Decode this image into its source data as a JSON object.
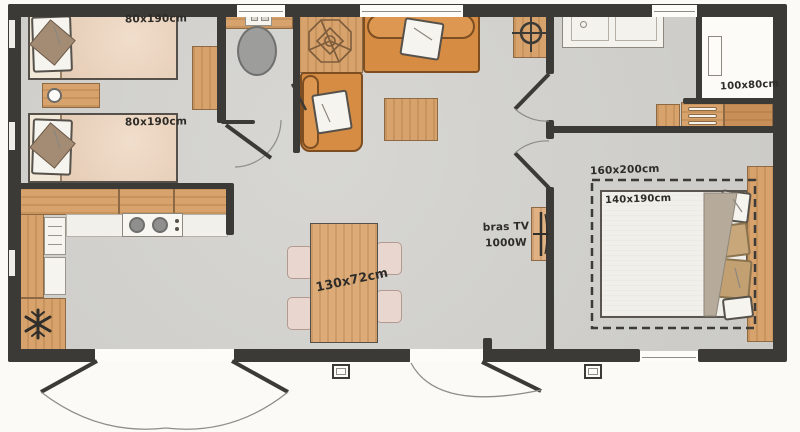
{
  "plan": {
    "type": "mobile-home floor plan",
    "labels": {
      "bed_single_top": "80x190cm",
      "bed_single_bottom": "80x190cm",
      "shower": "100x80cm",
      "master_zone": "160x200cm",
      "master_bed": "140x190cm",
      "tv_line1": "bras TV",
      "tv_line2": "1000W",
      "dining_table": "130x72cm"
    },
    "colors": {
      "wall": "#3b3a37",
      "floor": "#d3d2ce",
      "wood": "#d7a26c",
      "sofa_orange": "#d78c43",
      "duvet_peach": "#ecd2ba",
      "cushion_taupe": "#a38b74",
      "pillow_tan": "#c8a77b",
      "chair_pink": "#e9d7cf",
      "toilet_gray": "#9c9c9a",
      "exterior": "#fbfaf7"
    },
    "icons": {
      "fridge": "snowflake-icon",
      "water_heater": "crosshair-icon",
      "sofa_decor": "plant-icon",
      "wc_cistern": "flush-buttons-icon",
      "tv": "tv-bracket-icon",
      "nightstand": "round-lamp-icon"
    }
  }
}
